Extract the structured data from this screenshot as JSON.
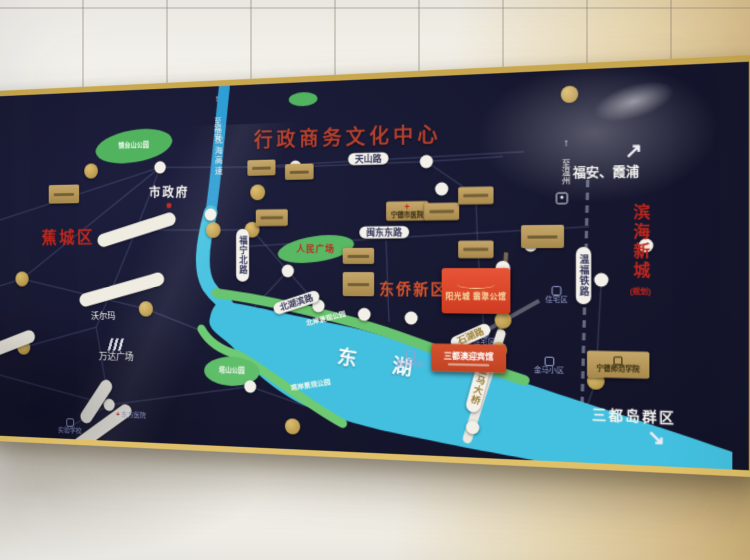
{
  "title": "行政商务文化中心",
  "districts": {
    "jiaocheng": "蕉城区",
    "dongqiao": "东侨新区",
    "binhai": "滨海新城",
    "binhai_note": "(规划)",
    "sandu_islands": "三都岛群区"
  },
  "directions": {
    "to_fuan": "至福安",
    "to_wenzhou": "至温州",
    "fuan_xiapu": "福安、霞浦"
  },
  "roads": {
    "tianshan": "天山路",
    "mindong_east": "闽东东路",
    "funing_north": "福宁北路",
    "beihubin": "北湖滨路",
    "shihu": "石湖路",
    "jinma": "金马路",
    "jinma_bridge": "金马大桥",
    "wenfu_railway": "温福铁路",
    "shenhai_expwy": "沈海高速"
  },
  "water": {
    "east_lake": "东湖"
  },
  "parks": {
    "jingtaishan": "镜台山公园",
    "renmin_square": "人民广场",
    "north_shore": "北岸景观公园",
    "south_shore": "南岸景观公园",
    "tashan": "塔山公园"
  },
  "places": {
    "city_hall": "市政府",
    "wanda_plaza": "万达广场",
    "walmart": "沃尔玛",
    "city_hospital": "宁德市医院",
    "normal_college": "宁德师范学院",
    "residential_1": "住宅区",
    "residential_2": "住宅区",
    "jinma_estate": "金马小区",
    "ferry_dock": "游船码头",
    "east_hospital": "东方医院",
    "experimental_school": "实验学校"
  },
  "projects": {
    "sunshine_city": "阳光城 翡翠公馆",
    "sandu_hotel": "三都澳迎宾馆"
  },
  "icons": {
    "arrow_ne": "↗",
    "arrow_se": "↘",
    "arrow_up": "↑",
    "cross": "+"
  },
  "colors": {
    "board_navy": "#15162e",
    "frame_gold": "#c9a84f",
    "lake_blue": "#45c2e0",
    "park_green": "#5fbe6a",
    "highlight_red": "#df4527",
    "title_red": "#b5402e"
  }
}
